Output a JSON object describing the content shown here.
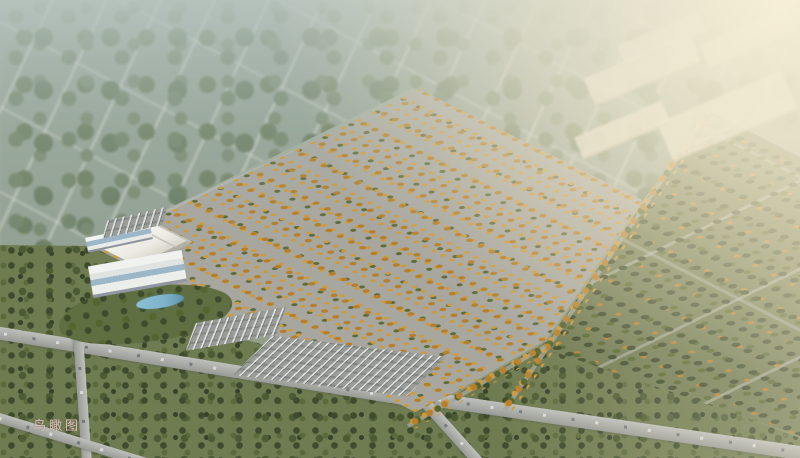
{
  "watermark": {
    "text": "鸟瞰图",
    "color": "#e6c8c6"
  },
  "palette": {
    "haze": "#bac7c2",
    "sun_glow": "#f7eed7",
    "distant_green": "#93a295",
    "warehouse_white": "#ecebe3",
    "warehouse_shadow": "#b2afa4",
    "autumn_orange": "#c5892f",
    "evergreen": "#41502e",
    "ground_olive": "#6f7b50",
    "road_gray": "#a5a8a2",
    "beige": "#ded7c5",
    "pond_blue": "#7fb2ca",
    "glass_blue": "#9cb8c8",
    "watermark_color": "#e6c8c6"
  }
}
